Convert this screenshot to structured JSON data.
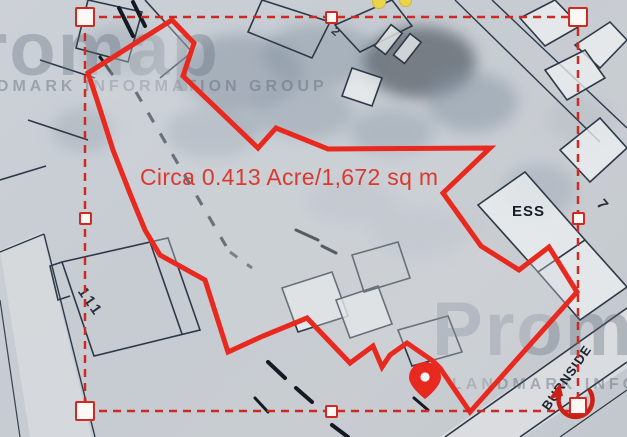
{
  "selection": {
    "area_label": "Circa 0.413 Acre/1,672 sq m"
  },
  "watermarks": {
    "brand": "Promap",
    "subtitle": "LANDMARK INFORMATION GROUP"
  },
  "map_labels": {
    "ess": "ESS",
    "house_111": "111",
    "house_7": "7",
    "house_2": "2",
    "road_burnside": "BURNSIDE"
  },
  "icons": {
    "pin": "location-pin",
    "rotate": "circular-rotate-arrow",
    "handles": "square-resize-handles",
    "yellow_dots": "yellow-point-markers"
  },
  "colors": {
    "boundary_red": "#e8291f",
    "selection_red": "#cf2a21",
    "area_text_red": "#d93a2f",
    "handle_fill": "#fdf7f5",
    "yellow_marker": "#e9d44a",
    "map_line": "#2e3947"
  }
}
